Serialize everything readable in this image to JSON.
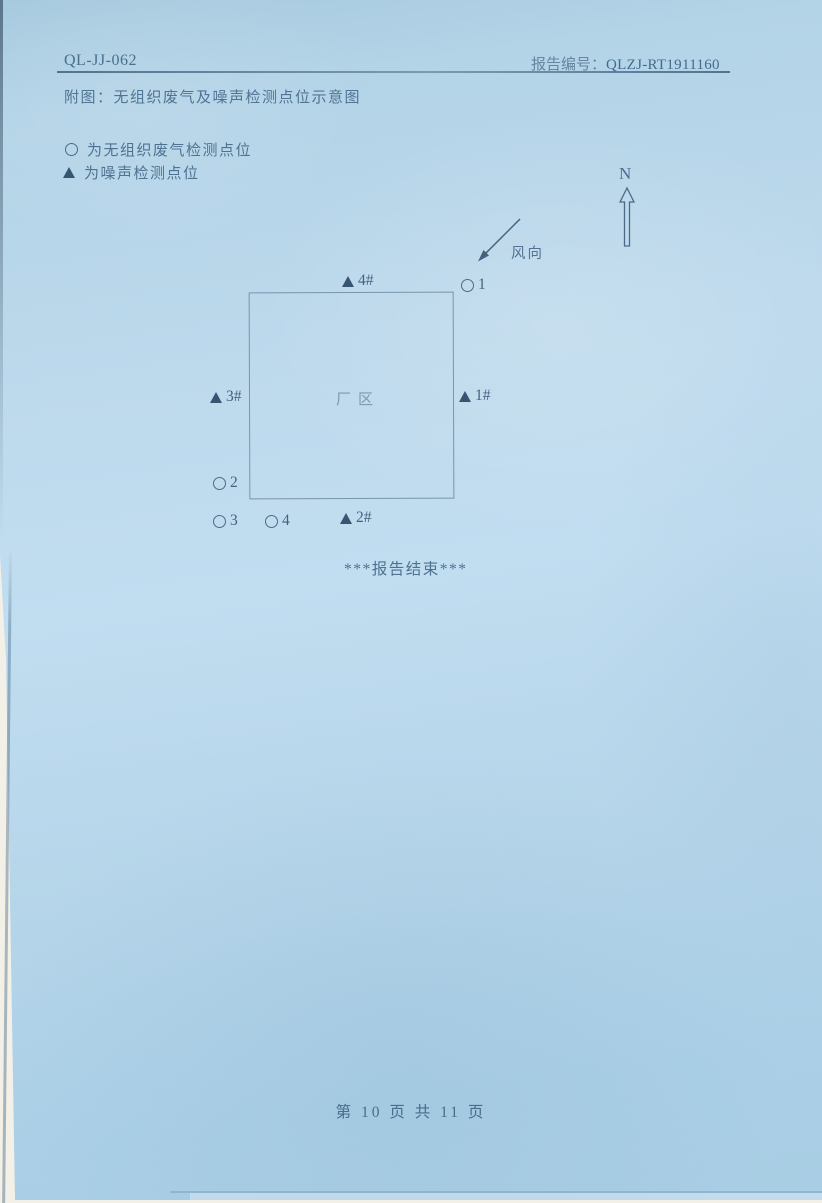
{
  "colors": {
    "paper_blue": "#bdd9ec",
    "paper_blue_dark": "#a6c9de",
    "ink": "#49708f",
    "ink_faint": "#7d9ab0",
    "marker_dark": "#365572",
    "backdrop": "#f3f0e7"
  },
  "header": {
    "doc_code": "QL-JJ-062",
    "report_label": "报告编号：",
    "report_number": "QLZJ-RT1911160",
    "figure_caption": "附图：无组织废气及噪声检测点位示意图"
  },
  "legend": {
    "items": [
      {
        "icon": "circle-marker",
        "label": "为无组织废气检测点位"
      },
      {
        "icon": "triangle-marker",
        "label": "为噪声检测点位"
      }
    ]
  },
  "diagram": {
    "north_label": "N",
    "wind_label": "风向",
    "factory_label": "厂区",
    "points": [
      {
        "type": "triangle",
        "label": "4#"
      },
      {
        "type": "circle",
        "label": "1"
      },
      {
        "type": "triangle",
        "label": "3#"
      },
      {
        "type": "triangle",
        "label": "1#"
      },
      {
        "type": "circle",
        "label": "2"
      },
      {
        "type": "circle",
        "label": "3"
      },
      {
        "type": "circle",
        "label": "4"
      },
      {
        "type": "triangle",
        "label": "2#"
      }
    ]
  },
  "body_text": {
    "end_of_report": "***报告结束***"
  },
  "footer": {
    "page_info": "第 10 页  共 11 页"
  }
}
